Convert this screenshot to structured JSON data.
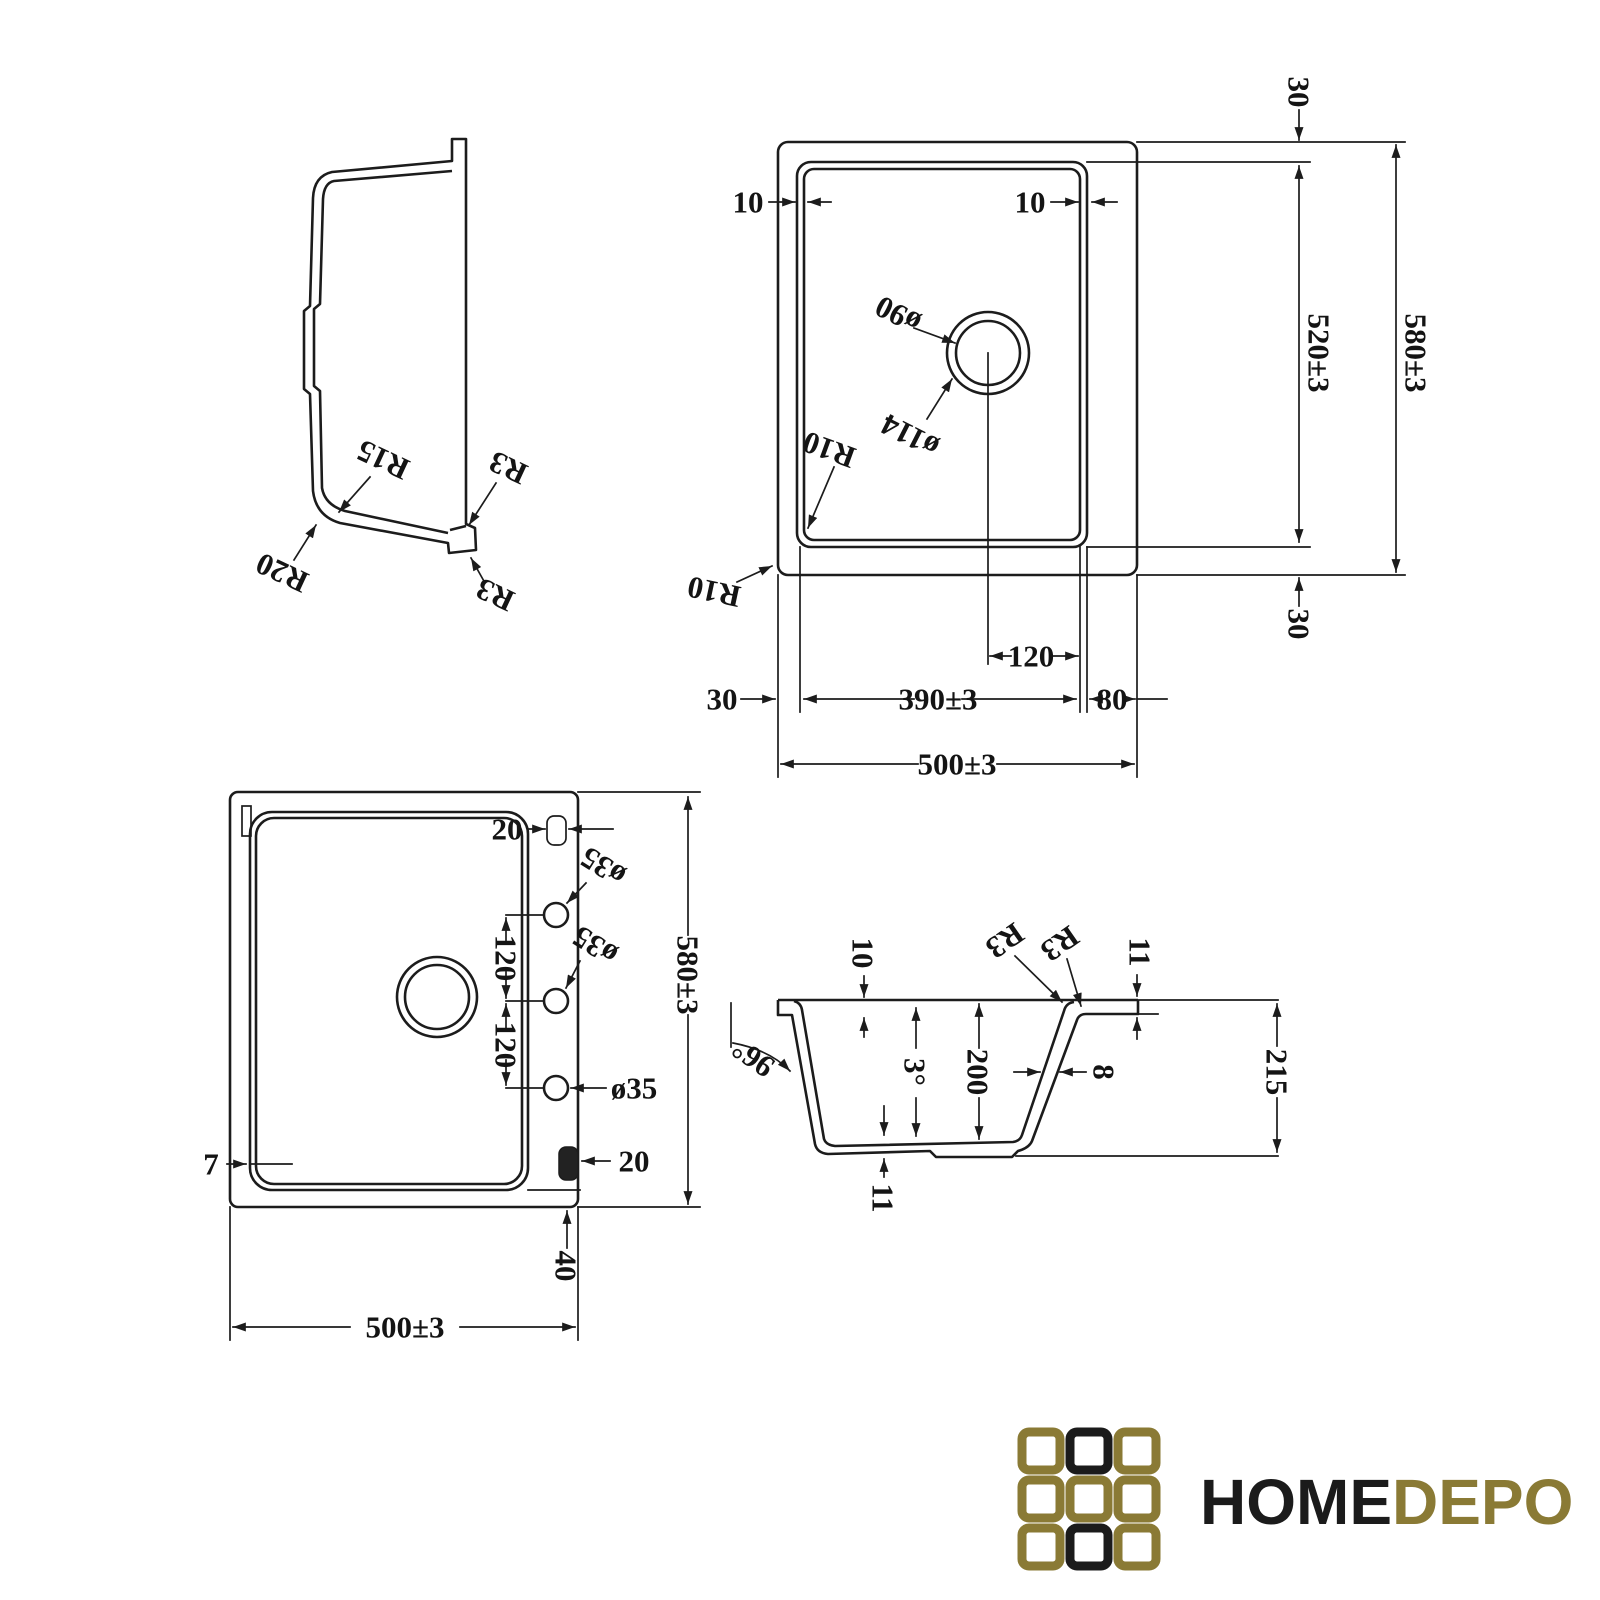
{
  "drawing": {
    "background": "#ffffff",
    "line_color": "#1c1c1c",
    "side_profile": {
      "inner_bottom_radius": "R15",
      "outer_bottom_radius": "R20",
      "step_radius_inner": "R3",
      "step_radius_outer": "R3"
    },
    "top_view": {
      "rim_left": "10",
      "rim_right": "10",
      "top_offset": "30",
      "bowl_length": "520±3",
      "overall_length": "580±3",
      "bottom_offset": "30",
      "drain_hole": "ø90",
      "drain_recess": "ø114",
      "bowl_corner_radius": "R10",
      "outer_corner_radius": "R10",
      "drain_offset": "120",
      "left_offset": "30",
      "bowl_width": "390±3",
      "right_offset": "80",
      "overall_width": "500±3"
    },
    "bottom_view": {
      "clip_top": "20",
      "tap_hole_1": "ø35",
      "tap_hole_2": "ø35",
      "tap_hole_3": "ø35",
      "hole_spacing_1": "120",
      "hole_spacing_2": "120",
      "overall_length": "580±3",
      "lip": "7",
      "clip_bottom": "20",
      "underside_offset": "40",
      "overall_width": "500±3"
    },
    "section_view": {
      "rim_depth": "10",
      "corner_radius_inner": "R3",
      "corner_radius_outer": "R3",
      "flange_thickness": "11",
      "wall_angle": "96°",
      "base_slope": "3°",
      "bowl_depth": "200",
      "wall_thickness": "8",
      "overall_depth": "215",
      "base_thickness": "11"
    }
  },
  "logo": {
    "word_primary": "HOME",
    "word_secondary": "DEPO",
    "colors": {
      "olive": "#8a7a35",
      "black": "#1b1b1b"
    }
  }
}
